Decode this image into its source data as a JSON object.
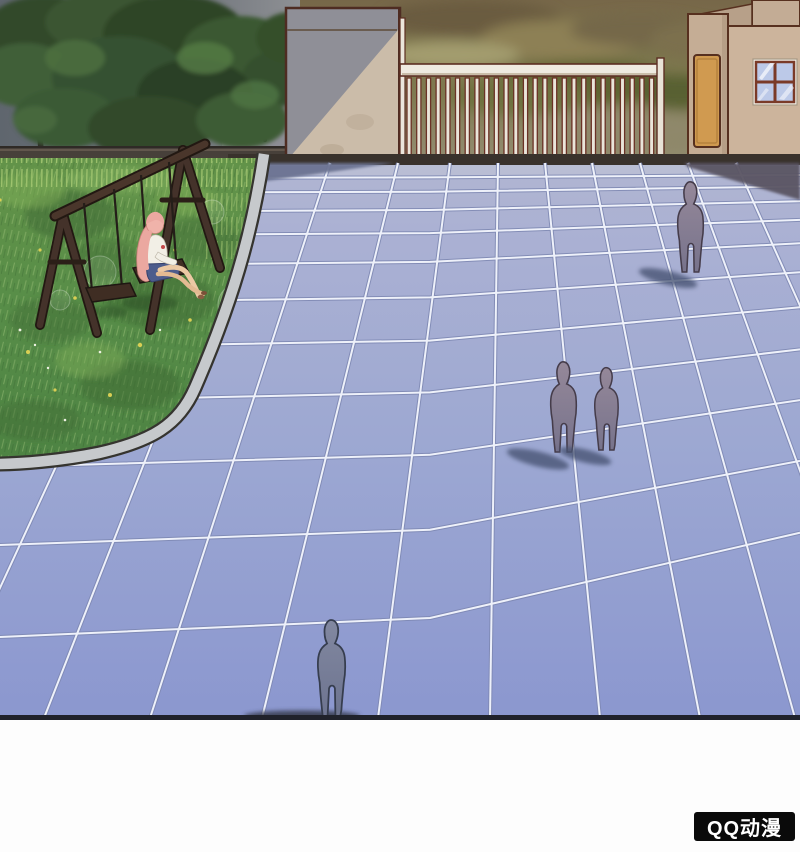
{
  "watermark": {
    "label": "QQ动漫",
    "bg": "#0a0a0a",
    "fg": "#ffffff"
  },
  "scene": {
    "type": "comic-panel",
    "figure_count": 4,
    "colors": {
      "tile": "#9fa9d2",
      "tile_bottom": "#8b97cf",
      "tile_grout": "#eef1fa",
      "grout_shadow": "#7d87b2",
      "grass": "#58904a",
      "grass_dark": "#3e6a33",
      "curb": "#c6c9cc",
      "wall_lit": "#cbbca9",
      "wall_shade": "#8f8f97",
      "outline_maroon": "#5c2e22",
      "gate_bar_white": "#eae5da",
      "gate_bar_edge": "#6b3226",
      "building": "#ccb49c",
      "door": "#d09a50",
      "window_glass": "#bcc9e8",
      "window_frame": "#7a3a28",
      "foliage": "#33492b",
      "tree_backdrop": "#656b72",
      "backdrop_olive": "#7b744c",
      "silhouette": "#8b8095",
      "silhouette_outline": "#453c4a",
      "cast_shadow": "#4a5474",
      "hair_pink": "#eba8a0",
      "shirt_white": "#f2efe6",
      "skirt_blue": "#4d5c8c",
      "swing_wood": "#38291f",
      "panel_border": "#20222b",
      "page_bg": "#ffffff"
    }
  }
}
